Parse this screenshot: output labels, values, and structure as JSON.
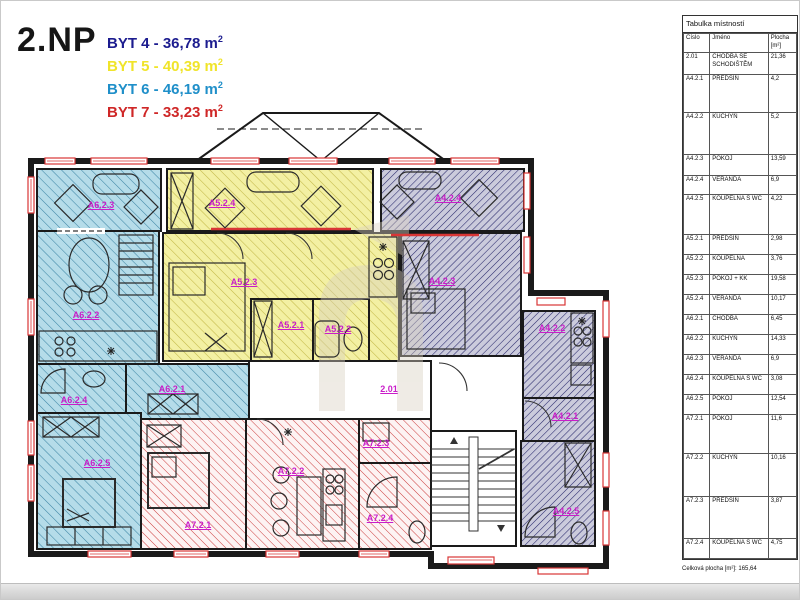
{
  "title": "2.NP",
  "legend": {
    "items": [
      {
        "text": "BYT 4 - 36,78 m",
        "sup": "2",
        "color": "#1c1c8f"
      },
      {
        "text": "BYT 5 - 40,39 m",
        "sup": "2",
        "color": "#f0e42a"
      },
      {
        "text": "BYT 6 - 46,19 m",
        "sup": "2",
        "color": "#1f8fc9"
      },
      {
        "text": "BYT 7 - 33,23 m",
        "sup": "2",
        "color": "#cf2727"
      }
    ]
  },
  "plan": {
    "label_color": "#c91dc9",
    "wall_color": "#1a1a1a",
    "window_color": "#d93636",
    "apartment_colors": {
      "byt4": {
        "fill": "#cbcbdc",
        "hatch": "#28286b"
      },
      "byt5": {
        "fill": "#f3f0a3",
        "hatch": "#c3b847"
      },
      "byt6": {
        "fill": "#b5dce9",
        "hatch": "#3f87a6"
      },
      "byt7": {
        "fill": "#fdf3f3",
        "hatch": "#cc3d3d"
      }
    },
    "labels": {
      "a623": "A6.2.3",
      "a524": "A5.2.4",
      "a424": "A4.2.4",
      "a622": "A6.2.2",
      "a523": "A5.2.3",
      "a521": "A5.2.1",
      "a522": "A5.2.2",
      "a423": "A4.2.3",
      "a422": "A4.2.2",
      "a421": "A4.2.1",
      "a425": "A4.2.5",
      "a624": "A6.2.4",
      "a621": "A6.2.1",
      "a625": "A6.2.5",
      "a201": "2.01",
      "a721": "A7.2.1",
      "a722": "A7.2.2",
      "a723": "A7.2.3",
      "a724": "A7.2.4"
    }
  },
  "table": {
    "title": "Tabulka místností",
    "columns": [
      "Číslo",
      "Jméno",
      "Plocha [m²]"
    ],
    "rows": [
      {
        "id": "2.01",
        "name": "CHODBA SE SCHODIŠTĚM",
        "area": "21,36"
      },
      {
        "id": "A4.2.1",
        "name": "PŘEDSÍŇ",
        "area": "4,2"
      },
      {
        "id": "A4.2.2",
        "name": "KUCHYŇ",
        "area": "5,2"
      },
      {
        "id": "A4.2.3",
        "name": "POKOJ",
        "area": "13,59"
      },
      {
        "id": "A4.2.4",
        "name": "VERANDA",
        "area": "6,9"
      },
      {
        "id": "A4.2.5",
        "name": "KOUPELNA S WC",
        "area": "4,22"
      },
      {
        "id": "A5.2.1",
        "name": "PŘEDSÍŇ",
        "area": "2,98"
      },
      {
        "id": "A5.2.2",
        "name": "KOUPELNA",
        "area": "3,76"
      },
      {
        "id": "A5.2.3",
        "name": "POKOJ + KK",
        "area": "19,58"
      },
      {
        "id": "A5.2.4",
        "name": "VERANDA",
        "area": "10,17"
      },
      {
        "id": "A6.2.1",
        "name": "CHODBA",
        "area": "6,45"
      },
      {
        "id": "A6.2.2",
        "name": "KUCHYŇ",
        "area": "14,33"
      },
      {
        "id": "A6.2.3",
        "name": "VERANDA",
        "area": "6,9"
      },
      {
        "id": "A6.2.4",
        "name": "KOUPELNA S WC",
        "area": "3,08"
      },
      {
        "id": "A6.2.5",
        "name": "POKOJ",
        "area": "12,54"
      },
      {
        "id": "A7.2.1",
        "name": "POKOJ",
        "area": "11,6"
      },
      {
        "id": "A7.2.2",
        "name": "KUCHYŇ",
        "area": "10,16"
      },
      {
        "id": "A7.2.3",
        "name": "PŘEDSÍŇ",
        "area": "3,87"
      },
      {
        "id": "A7.2.4",
        "name": "KOUPELNA S WC",
        "area": "4,75"
      }
    ],
    "footer_label": "Celková plocha [m²]:",
    "footer_value": "165,64"
  }
}
